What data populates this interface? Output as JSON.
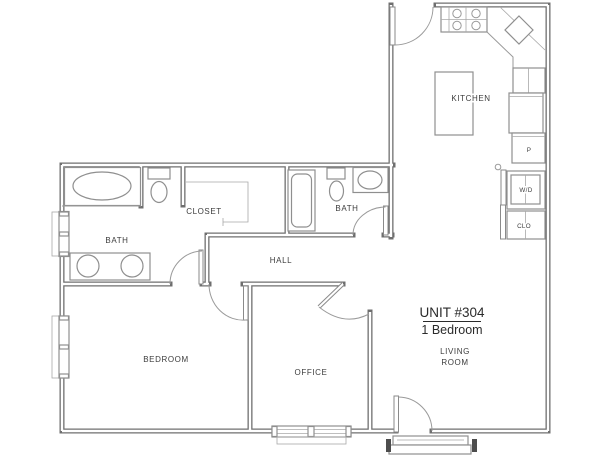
{
  "floor_plan": {
    "unit_title": "UNIT #304",
    "unit_subtitle": "1 Bedroom",
    "labels": {
      "kitchen": "KITCHEN",
      "bath_main": "BATH",
      "bath_second": "BATH",
      "closet": "CLOSET",
      "hall": "HALL",
      "bedroom": "BEDROOM",
      "office": "OFFICE",
      "living_line1": "LIVING",
      "living_line2": "ROOM",
      "washer_dryer": "W/D",
      "coat_closet": "CLO",
      "pantry": "P"
    },
    "colors": {
      "wall": "#6f6f6f",
      "fixture": "#8f8f8f",
      "text": "#3c3c3c",
      "background": "#ffffff"
    }
  }
}
